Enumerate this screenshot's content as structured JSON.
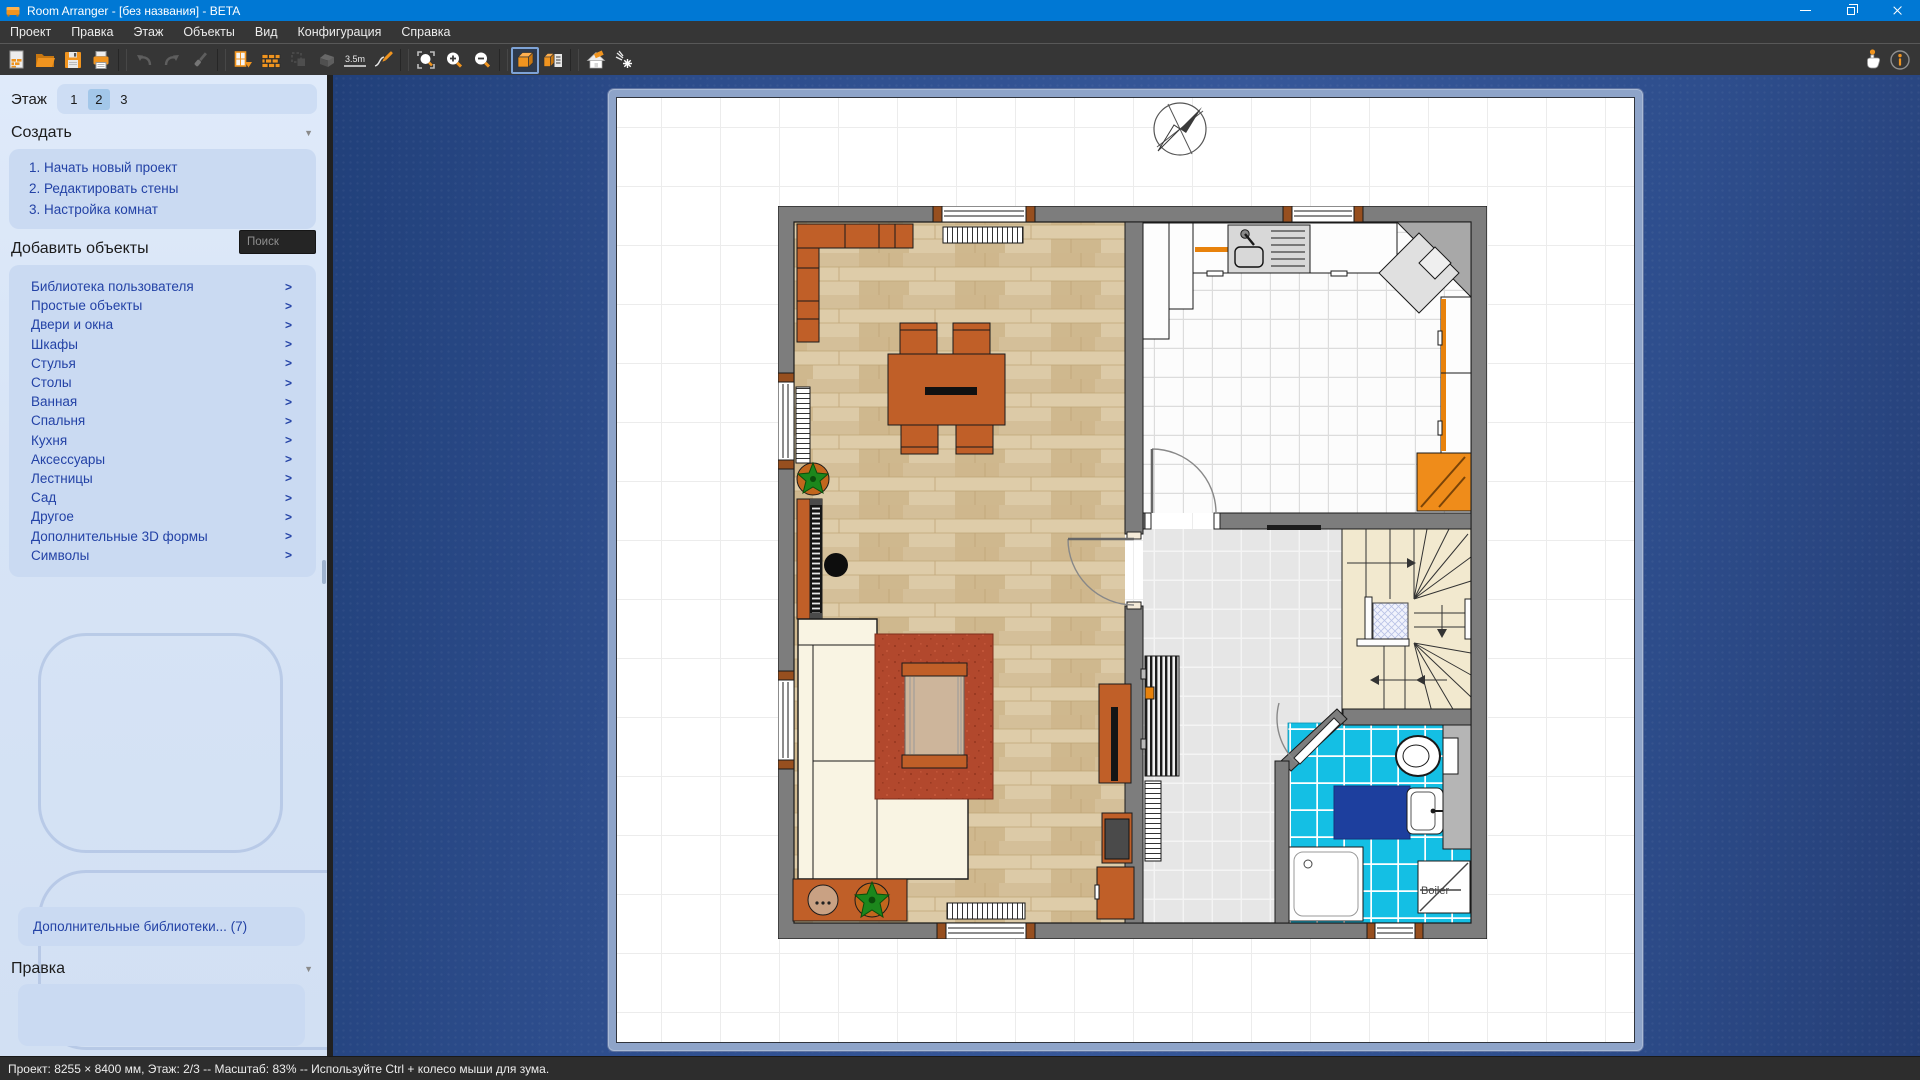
{
  "window": {
    "title": "Room Arranger - [без названия] - BETA"
  },
  "menu": {
    "items": [
      "Проект",
      "Правка",
      "Этаж",
      "Объекты",
      "Вид",
      "Конфигурация",
      "Справка"
    ]
  },
  "toolbar": {
    "measure_label": "3.5m"
  },
  "icons": {
    "chevron": ">",
    "collapse": "▼"
  },
  "sidebar": {
    "floor": {
      "label": "Этаж",
      "options": [
        "1",
        "2",
        "3"
      ],
      "selected": "2"
    },
    "create": {
      "title": "Создать",
      "items": [
        "1. Начать новый проект",
        "2. Редактировать стены",
        "3. Настройка комнат"
      ]
    },
    "add_objects": {
      "title": "Добавить объекты",
      "search_placeholder": "Поиск",
      "items": [
        "Библиотека пользователя",
        "Простые объекты",
        "Двери и окна",
        "Шкафы",
        "Стулья",
        "Столы",
        "Ванная",
        "Спальня",
        "Кухня",
        "Аксессуары",
        "Лестницы",
        "Сад",
        "Другое",
        "Дополнительные 3D формы",
        "Символы"
      ]
    },
    "more_libraries": "Дополнительные библиотеки... (7)",
    "edit": {
      "title": "Правка"
    }
  },
  "canvas": {
    "boiler_label": "Boiler"
  },
  "statusbar": {
    "text": "Проект: 8255 × 8400 мм, Этаж: 2/3 -- Масштаб: 83% -- Используйте Ctrl + колесо мыши для зума."
  },
  "colors": {
    "titlebar": "#0078d4",
    "toolbar_bg": "#363636",
    "accent_orange": "#f0941f",
    "sidebar_bg": "#d7e4f6",
    "sidebar_card": "#cadaf2",
    "link_blue": "#2342a6",
    "canvas_blue": "#2d4d8c",
    "wall_gray": "#7d7d7d",
    "wood_floor": "#d9c6a1",
    "bathroom_tile": "#14bfe4",
    "furniture_orange": "#c05f28",
    "carpet_red": "#b2482d",
    "stairs_cream": "#f2e9cf"
  }
}
